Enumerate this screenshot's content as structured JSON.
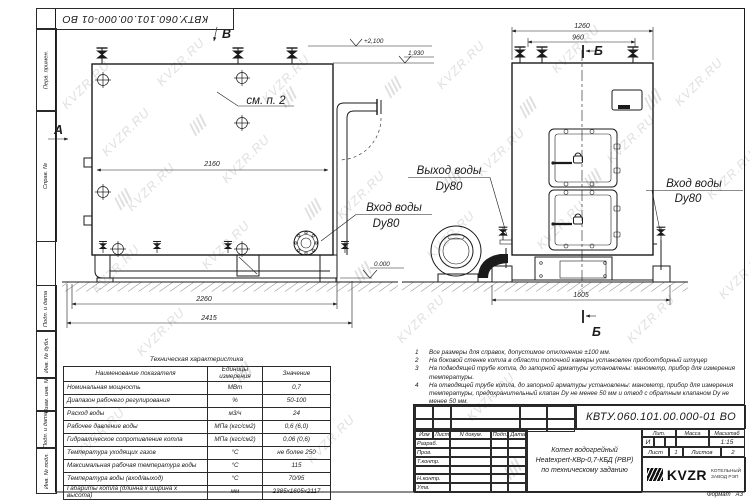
{
  "page": {
    "format_label": "Формат",
    "format_value": "А3"
  },
  "doc_number": "КВТУ.060.101.00.000-01 ВО",
  "watermark": {
    "text": "KVZR.RU"
  },
  "stamp_column": {
    "labels": [
      "Перв. примен.",
      "Справ. №",
      "Подп. и дата",
      "Инв. № дубл.",
      "Взам. инв. №",
      "Подп. и дата",
      "Инв. № подл."
    ]
  },
  "drawing": {
    "markers": {
      "a": "А",
      "b": "Б",
      "v": "В"
    },
    "callout": "см. п. 2",
    "dims": {
      "d2160": "2160",
      "d2260": "2260",
      "d2415": "2415",
      "d1260": "1260",
      "d960": "960",
      "d1605": "1605"
    },
    "levels": {
      "top": "+2,100",
      "boiler": "1,930",
      "ground": "0.000"
    },
    "labels": {
      "inlet_side_1": "Вход воды",
      "inlet_side_2": "Dy80",
      "outlet_front_1": "Выход воды",
      "outlet_front_2": "Dy80",
      "inlet_front_1": "Вход воды",
      "inlet_front_2": "Dy80"
    }
  },
  "spec_table": {
    "title": "Техническая характеристика",
    "headers": [
      "Наименование показателя",
      "Единицы измерения",
      "Значение"
    ],
    "rows": [
      [
        "Номинальная мощность",
        "МВт",
        "0,7"
      ],
      [
        "Диапазон рабочего регулирования",
        "%",
        "50-100"
      ],
      [
        "Расход воды",
        "м3/ч",
        "24"
      ],
      [
        "Рабочее давление воды",
        "МПа (кгс/см2)",
        "0,6 (6,0)"
      ],
      [
        "Гидравлическое сопротивление котла",
        "МПа (кгс/см2)",
        "0,06 (0,6)"
      ],
      [
        "Температура уходящих газов",
        "°С",
        "не более 250"
      ],
      [
        "Максимальная рабочая температура воды",
        "°С",
        "115"
      ],
      [
        "Температура воды (вход/выход)",
        "°С",
        "70/95"
      ],
      [
        "Габариты котла (длинна х ширина х высота)",
        "мм",
        "2385х1605х2117"
      ]
    ]
  },
  "notes": {
    "items": [
      {
        "n": "1",
        "text": "Все размеры для справок, допустимое отклонение ±100 мм."
      },
      {
        "n": "2",
        "text": "На боковой стенке котла в области топочной камеры установлен пробоотборный штуцер"
      },
      {
        "n": "3",
        "text": "На  подводящей трубе котла, до запорной арматуры установлены: манометр, прибор для измерения температуры."
      },
      {
        "n": "4",
        "text": "На отводящей трубе котла, до запорной арматуры установлены: манометр, прибор для измерения температуры, предохранительный клапан Dy не менее 50 мм и отвод с обратным клапаном Dy не менее 50 мм."
      }
    ]
  },
  "title_block": {
    "doc_number": "КВТУ.060.101.00.000-01 ВО",
    "change_cols": [
      "Изм",
      "Лист",
      "N докум.",
      "Подп.",
      "Дата"
    ],
    "roles": [
      "Разраб.",
      "Пров.",
      "Т.контр.",
      "",
      "Н.контр.",
      "Утв."
    ],
    "name_lines": [
      "Котел водогрейный",
      "Heatexpert-КВр-0,7-КБД (РВР)",
      "по техническому заданию"
    ],
    "lit_label": "Лит.",
    "mass_label": "Масса",
    "scale_label": "Масштаб",
    "lit_value": "И",
    "mass_value": "",
    "scale_value": "1:15",
    "sheet_label": "Лист",
    "sheet_value": "1",
    "sheets_label": "Листов",
    "sheets_value": "2",
    "company": {
      "logo": "KVZR",
      "line1": "КОТЕЛЬНЫЙ",
      "line2": "ЗАВОД РЭП"
    }
  }
}
